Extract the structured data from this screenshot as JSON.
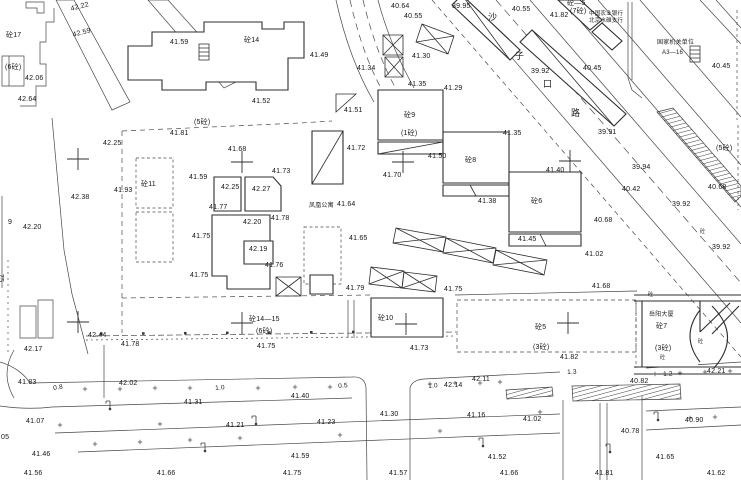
{
  "map": {
    "type": "cadastral-survey-plan",
    "road_name": {
      "name": "沙子口路",
      "chars": [
        {
          "t": "沙",
          "x": 488,
          "y": 13
        },
        {
          "t": "子",
          "x": 515,
          "y": 52
        },
        {
          "t": "口",
          "x": 543,
          "y": 80
        },
        {
          "t": "路",
          "x": 571,
          "y": 109
        }
      ]
    },
    "annotations": [
      {
        "t": "中国农业银行",
        "x": 589,
        "y": 12,
        "fs": 5.5
      },
      {
        "t": "北京水碓支行",
        "x": 589,
        "y": 19,
        "fs": 5.5
      },
      {
        "t": "国家机关单位",
        "x": 657,
        "y": 40,
        "fs": 6
      },
      {
        "t": "A3—16",
        "x": 662,
        "y": 50,
        "fs": 6
      },
      {
        "t": "凤凰公寓",
        "x": 309,
        "y": 203,
        "fs": 6
      },
      {
        "t": "岳阳大厦",
        "x": 649,
        "y": 312,
        "fs": 6
      }
    ],
    "building_labels": [
      {
        "t": "砼17",
        "x": 6,
        "y": 32
      },
      {
        "t": "(6砼)",
        "x": 5,
        "y": 64
      },
      {
        "t": "砼14",
        "x": 244,
        "y": 37
      },
      {
        "t": "(5砼)",
        "x": 194,
        "y": 119
      },
      {
        "t": "砼11",
        "x": 141,
        "y": 181
      },
      {
        "t": "砼9",
        "x": 404,
        "y": 112
      },
      {
        "t": "(1砼)",
        "x": 401,
        "y": 130
      },
      {
        "t": "砼8",
        "x": 465,
        "y": 157
      },
      {
        "t": "砼6",
        "x": 531,
        "y": 198
      },
      {
        "t": "砼—5",
        "x": 567,
        "y": 0
      },
      {
        "t": "(7砼)",
        "x": 570,
        "y": 8
      },
      {
        "t": "(5砼)",
        "x": 716,
        "y": 145
      },
      {
        "t": "砼14—15",
        "x": 249,
        "y": 316
      },
      {
        "t": "(6砼)",
        "x": 256,
        "y": 328
      },
      {
        "t": "砼10",
        "x": 378,
        "y": 315
      },
      {
        "t": "砼5",
        "x": 535,
        "y": 324
      },
      {
        "t": "(3砼)",
        "x": 533,
        "y": 344
      },
      {
        "t": "砼7",
        "x": 656,
        "y": 323
      },
      {
        "t": "(3砼)",
        "x": 655,
        "y": 345
      },
      {
        "t": "砼",
        "x": 648,
        "y": 293,
        "fs": 5
      },
      {
        "t": "砼",
        "x": 698,
        "y": 340,
        "fs": 5
      },
      {
        "t": "砼",
        "x": 660,
        "y": 356,
        "fs": 5
      },
      {
        "t": "砼",
        "x": 700,
        "y": 230,
        "fs": 5
      },
      {
        "t": "9",
        "x": 8,
        "y": 219
      },
      {
        "t": "75",
        "x": 4,
        "y": 274,
        "rot": 90
      }
    ],
    "spot_elevations": [
      {
        "t": "42.22",
        "x": 70,
        "y": 6,
        "rot": -15
      },
      {
        "t": "42.59",
        "x": 72,
        "y": 32,
        "rot": -15
      },
      {
        "t": "41.59",
        "x": 170,
        "y": 39
      },
      {
        "t": "42.06",
        "x": 25,
        "y": 75
      },
      {
        "t": "42.64",
        "x": 18,
        "y": 96
      },
      {
        "t": "41.49",
        "x": 310,
        "y": 52
      },
      {
        "t": "41.52",
        "x": 252,
        "y": 98
      },
      {
        "t": "41.51",
        "x": 344,
        "y": 107
      },
      {
        "t": "40.64",
        "x": 391,
        "y": 3
      },
      {
        "t": "40.55",
        "x": 404,
        "y": 13
      },
      {
        "t": "39.95",
        "x": 452,
        "y": 3
      },
      {
        "t": "40.55",
        "x": 512,
        "y": 6
      },
      {
        "t": "41.82",
        "x": 550,
        "y": 12
      },
      {
        "t": "41.34",
        "x": 357,
        "y": 65
      },
      {
        "t": "41.30",
        "x": 412,
        "y": 53
      },
      {
        "t": "41.35",
        "x": 408,
        "y": 81
      },
      {
        "t": "41.29",
        "x": 444,
        "y": 85
      },
      {
        "t": "39.92",
        "x": 531,
        "y": 68
      },
      {
        "t": "40.45",
        "x": 583,
        "y": 65
      },
      {
        "t": "40.45",
        "x": 712,
        "y": 63
      },
      {
        "t": "39.91",
        "x": 598,
        "y": 129
      },
      {
        "t": "41.40",
        "x": 546,
        "y": 167
      },
      {
        "t": "39.94",
        "x": 632,
        "y": 164
      },
      {
        "t": "40.42",
        "x": 622,
        "y": 186
      },
      {
        "t": "40.68",
        "x": 708,
        "y": 184
      },
      {
        "t": "39.92",
        "x": 672,
        "y": 201
      },
      {
        "t": "40.68",
        "x": 594,
        "y": 217
      },
      {
        "t": "39.92",
        "x": 712,
        "y": 244
      },
      {
        "t": "41.02",
        "x": 585,
        "y": 251
      },
      {
        "t": "41.68",
        "x": 592,
        "y": 283
      },
      {
        "t": "41.35",
        "x": 503,
        "y": 130
      },
      {
        "t": "41.50",
        "x": 428,
        "y": 153
      },
      {
        "t": "41.70",
        "x": 383,
        "y": 172
      },
      {
        "t": "41.38",
        "x": 478,
        "y": 198
      },
      {
        "t": "41.45",
        "x": 518,
        "y": 236
      },
      {
        "t": "41.72",
        "x": 347,
        "y": 145
      },
      {
        "t": "41.68",
        "x": 228,
        "y": 146
      },
      {
        "t": "41.73",
        "x": 272,
        "y": 168
      },
      {
        "t": "42.25",
        "x": 221,
        "y": 184
      },
      {
        "t": "42.27",
        "x": 252,
        "y": 186
      },
      {
        "t": "41.77",
        "x": 209,
        "y": 204
      },
      {
        "t": "42.20",
        "x": 243,
        "y": 219
      },
      {
        "t": "41.78",
        "x": 271,
        "y": 215
      },
      {
        "t": "42.19",
        "x": 249,
        "y": 246
      },
      {
        "t": "41.76",
        "x": 265,
        "y": 262
      },
      {
        "t": "41.64",
        "x": 337,
        "y": 201
      },
      {
        "t": "41.65",
        "x": 349,
        "y": 235
      },
      {
        "t": "41.59",
        "x": 189,
        "y": 174
      },
      {
        "t": "41.93",
        "x": 114,
        "y": 187
      },
      {
        "t": "42.38",
        "x": 71,
        "y": 194
      },
      {
        "t": "41.75",
        "x": 192,
        "y": 233
      },
      {
        "t": "41.75",
        "x": 190,
        "y": 272
      },
      {
        "t": "42.25",
        "x": 103,
        "y": 140
      },
      {
        "t": "41.81",
        "x": 170,
        "y": 130
      },
      {
        "t": "42.20",
        "x": 23,
        "y": 224
      },
      {
        "t": "42.17",
        "x": 24,
        "y": 346
      },
      {
        "t": "42.44",
        "x": 88,
        "y": 332
      },
      {
        "t": "41.78",
        "x": 121,
        "y": 341
      },
      {
        "t": "41.83",
        "x": 18,
        "y": 379
      },
      {
        "t": "42.02",
        "x": 119,
        "y": 380
      },
      {
        "t": "41.79",
        "x": 346,
        "y": 285
      },
      {
        "t": "41.75",
        "x": 444,
        "y": 286
      },
      {
        "t": "41.75",
        "x": 257,
        "y": 343
      },
      {
        "t": "41.73",
        "x": 410,
        "y": 345
      },
      {
        "t": "41.82",
        "x": 560,
        "y": 354
      },
      {
        "t": "42.21",
        "x": 707,
        "y": 368
      },
      {
        "t": "40.82",
        "x": 630,
        "y": 378
      },
      {
        "t": "42.14",
        "x": 444,
        "y": 382
      },
      {
        "t": "42.11",
        "x": 472,
        "y": 376
      },
      {
        "t": "41.40",
        "x": 291,
        "y": 393
      },
      {
        "t": "41.31",
        "x": 184,
        "y": 399
      },
      {
        "t": "41.30",
        "x": 380,
        "y": 411
      },
      {
        "t": "41.16",
        "x": 467,
        "y": 412
      },
      {
        "t": "41.23",
        "x": 317,
        "y": 419
      },
      {
        "t": "41.07",
        "x": 26,
        "y": 418
      },
      {
        "t": "41.21",
        "x": 226,
        "y": 422
      },
      {
        "t": "41.02",
        "x": 523,
        "y": 416
      },
      {
        "t": "40.90",
        "x": 685,
        "y": 417
      },
      {
        "t": "40.78",
        "x": 621,
        "y": 428
      },
      {
        "t": "41.46",
        "x": 32,
        "y": 451
      },
      {
        "t": "41.59",
        "x": 291,
        "y": 453
      },
      {
        "t": "41.52",
        "x": 488,
        "y": 454
      },
      {
        "t": "41.65",
        "x": 656,
        "y": 454
      },
      {
        "t": "41.56",
        "x": 24,
        "y": 470
      },
      {
        "t": "41.66",
        "x": 157,
        "y": 470
      },
      {
        "t": "41.75",
        "x": 283,
        "y": 470
      },
      {
        "t": "41.57",
        "x": 389,
        "y": 470
      },
      {
        "t": "41.66",
        "x": 500,
        "y": 470
      },
      {
        "t": "41.81",
        "x": 595,
        "y": 470
      },
      {
        "t": "41.62",
        "x": 707,
        "y": 470
      },
      {
        "t": "05",
        "x": 1,
        "y": 434
      }
    ],
    "dimensions": [
      {
        "t": "0.8",
        "x": 53,
        "y": 386,
        "rot": -8
      },
      {
        "t": "1.0",
        "x": 215,
        "y": 386,
        "rot": -5
      },
      {
        "t": "0.5",
        "x": 338,
        "y": 384,
        "rot": -5
      },
      {
        "t": "1.0",
        "x": 428,
        "y": 384,
        "rot": -5
      },
      {
        "t": "1.3",
        "x": 567,
        "y": 370,
        "rot": -3
      },
      {
        "t": "1.2",
        "x": 663,
        "y": 372,
        "rot": -3
      }
    ],
    "survey_crosses": [
      {
        "x": 78,
        "y": 159
      },
      {
        "x": 242,
        "y": 162
      },
      {
        "x": 403,
        "y": 162
      },
      {
        "x": 570,
        "y": 161
      },
      {
        "x": 78,
        "y": 322
      },
      {
        "x": 242,
        "y": 323
      },
      {
        "x": 406,
        "y": 324
      },
      {
        "x": 568,
        "y": 323
      }
    ]
  }
}
